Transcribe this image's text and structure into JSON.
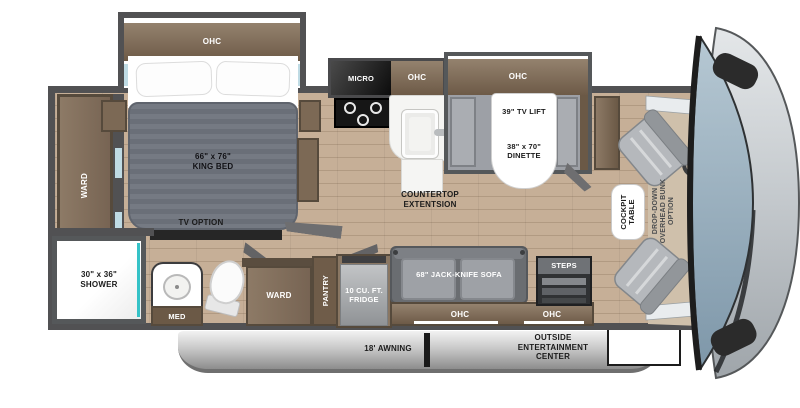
{
  "labels": {
    "ohc": "OHC",
    "micro": "MICRO",
    "king_bed": "66\" x 76\"\nKING BED",
    "ward": "WARD",
    "tv_option": "TV OPTION",
    "shower": "30\" x 36\"\nSHOWER",
    "med": "MED",
    "tv_lift": "39\" TV LIFT",
    "dinette": "38\" x 70\"\nDINETTE",
    "countertop_extension": "COUNTERTOP\nEXTENTSION",
    "pantry": "PANTRY",
    "fridge": "10 CU. FT.\nFRIDGE",
    "sofa": "68\" JACK-KNIFE SOFA",
    "steps": "STEPS",
    "cockpit_table": "COCKPIT\nTABLE",
    "overhead_bunk": "DROP-DOWN\nOVERHEAD BUNK\nOPTION",
    "awning": "18' AWNING",
    "outside_entertainment": "OUTSIDE\nENTERTAINMENT\nCENTER"
  },
  "colors": {
    "wall": "#515153",
    "floor": "#c6af97",
    "floor_line": "#b19a82",
    "cabinet": "#8a7763",
    "cabinet_dark": "#6b5946",
    "cabinet_edge": "#564a3c",
    "mattress": "#6f747d",
    "furniture_gray": "#a3a6ab",
    "steps_dark": "#3f4143",
    "shower_teal": "#35c2c7",
    "window_blue": "#bfdbe4",
    "awning_light": "#f2f2f2",
    "awning_dark": "#8d8d8d",
    "windshield_top": "#b6c8d3",
    "windshield_bottom": "#7e97a9",
    "nose_light": "#e4e7e9",
    "nose_dark": "#9fa5aa",
    "mirror_black": "#2b2b2b",
    "screen_blue": "#3fa0d5",
    "label_dark": "#1b1b1b"
  }
}
